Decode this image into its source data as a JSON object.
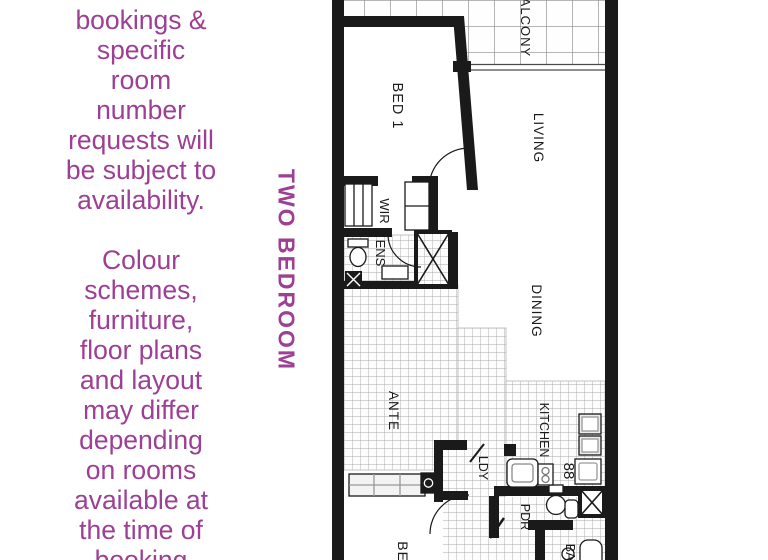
{
  "colors": {
    "accent": "#9d3f94",
    "wall": "#1a1a1a"
  },
  "sidebar": {
    "para1": [
      "bookings &",
      "specific",
      "room",
      "number",
      "requests will",
      "be subject to",
      "availability."
    ],
    "para2": [
      "Colour",
      "schemes,",
      "furniture,",
      "floor plans",
      "and layout",
      "may differ",
      "depending",
      "on rooms",
      "available at",
      "the time of",
      "booking"
    ],
    "vertical_label": "TWO BEDROOM"
  },
  "floorplan": {
    "labels": {
      "balcony": "BALCONY",
      "bed1": "BED 1",
      "living": "LIVING",
      "wir": "WIR",
      "ens": "ENS",
      "dining": "DINING",
      "ante": "ANTE",
      "kitchen": "KITCHEN",
      "ldy": "LDY",
      "pdr": "PDR",
      "bed2": "BED 2",
      "bath": "BATH"
    },
    "stove_glyph": "88"
  }
}
